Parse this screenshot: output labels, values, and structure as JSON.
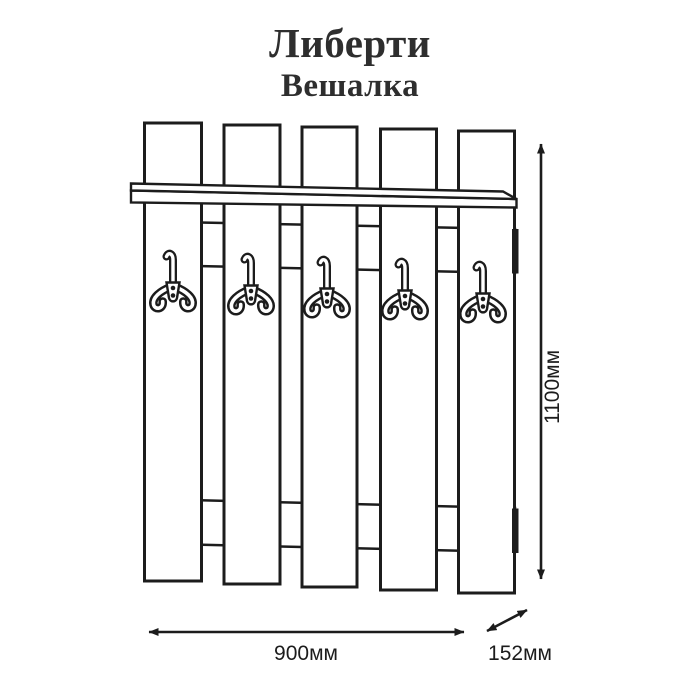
{
  "header": {
    "title": "Либерти",
    "subtitle": "Вешалка"
  },
  "dimensions": {
    "width": "900мм",
    "depth": "152мм",
    "height": "1100мм"
  },
  "structure": {
    "slat_count": 5,
    "hook_count": 5,
    "rail_count": 2,
    "has_shelf": true
  },
  "colors": {
    "line": "#1c1c1c",
    "background": "#ffffff",
    "title_text": "#2e2e2e"
  }
}
